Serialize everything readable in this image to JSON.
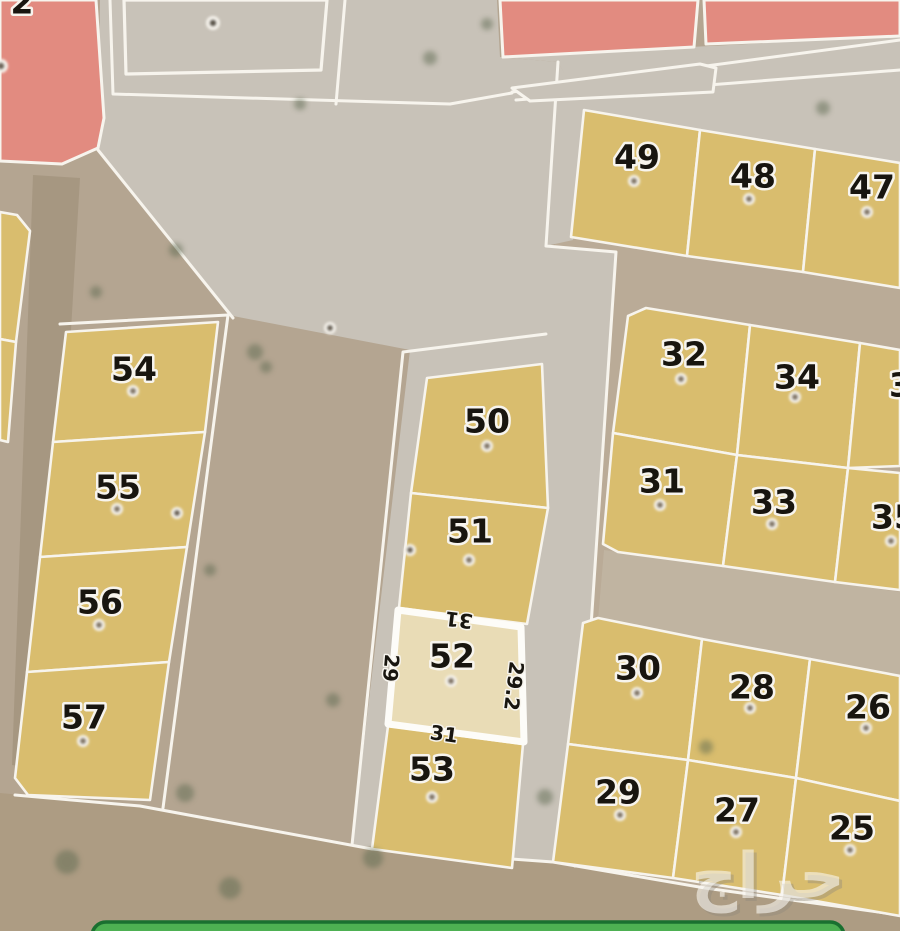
{
  "plots": {
    "25": "25",
    "26": "26",
    "27": "27",
    "28": "28",
    "29": "29",
    "30": "30",
    "31": "31",
    "32": "32",
    "33": "33",
    "34": "34",
    "35": "35",
    "36_partial": "36",
    "47": "47",
    "48": "48",
    "49": "49",
    "50": "50",
    "51": "51",
    "52": "52",
    "53": "53",
    "54": "54",
    "55": "55",
    "56": "56",
    "57": "57",
    "topleft_partial": "2"
  },
  "highlighted_plot": {
    "number": "52",
    "dim_top": "31",
    "dim_left": "29",
    "dim_right": "29.2",
    "dim_bottom": "31"
  },
  "watermark": {
    "text": "حراج"
  },
  "colors": {
    "parcel_yellow": "#d9bd6e",
    "parcel_highlight": "#e9dcb6",
    "parcel_red": "#e28b80",
    "road_gray": "#c8c2b8",
    "ground_tan": "#b4a591",
    "ground_dark": "#ad9c83",
    "line_white": "#f7f4ed",
    "number_black": "#18150f",
    "button_green": "#4db052",
    "button_green_border": "#1a7030",
    "watermark_white": "#fbf9f4"
  }
}
